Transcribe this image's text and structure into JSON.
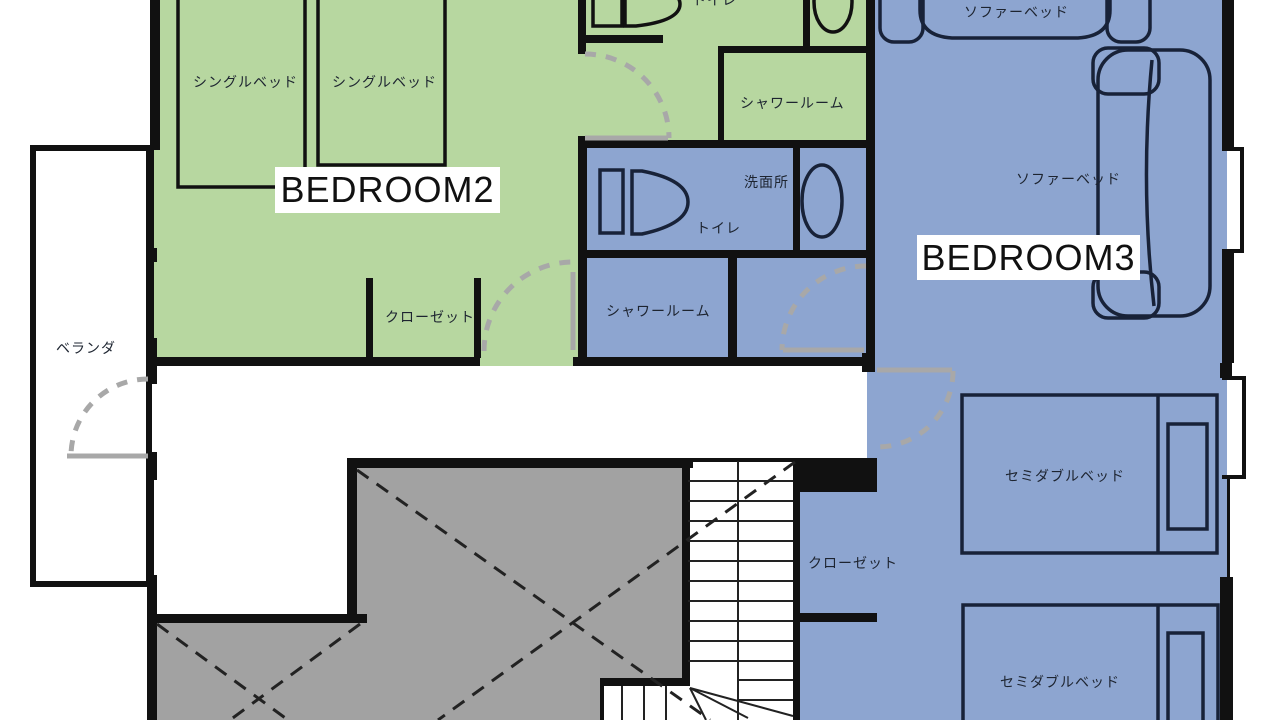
{
  "floorplan": {
    "rooms": {
      "bedroom2": {
        "name": "BEDROOM2"
      },
      "bedroom3": {
        "name": "BEDROOM3"
      },
      "balcony": {
        "name": "ベランダ"
      },
      "shower_room_green": {
        "name": "シャワールーム"
      },
      "shower_room_blue": {
        "name": "シャワールーム"
      },
      "toilet_green": {
        "name": "トイレ"
      },
      "toilet_blue": {
        "name": "トイレ"
      },
      "washroom": {
        "name": "洗面所"
      }
    },
    "furniture": {
      "single_bed_1": "シングルベッド",
      "single_bed_2": "シングルベッド",
      "sofa_bed_1": "ソファーベッド",
      "sofa_bed_2": "ソファーベッド",
      "semi_double_bed_1": "セミダブルベッド",
      "semi_double_bed_2": "セミダブルベッド",
      "closet_bedroom2": "クローゼット",
      "closet_bedroom3": "クローゼット"
    },
    "colors": {
      "bedroom2_fill": "#b7d7a0",
      "bedroom3_fill": "#8da5d0",
      "void_fill": "#a2a2a2",
      "wall": "#111111",
      "door_swing": "#a8a8a8",
      "furniture_outline": "#182238",
      "label_background": "#ffffff"
    }
  }
}
